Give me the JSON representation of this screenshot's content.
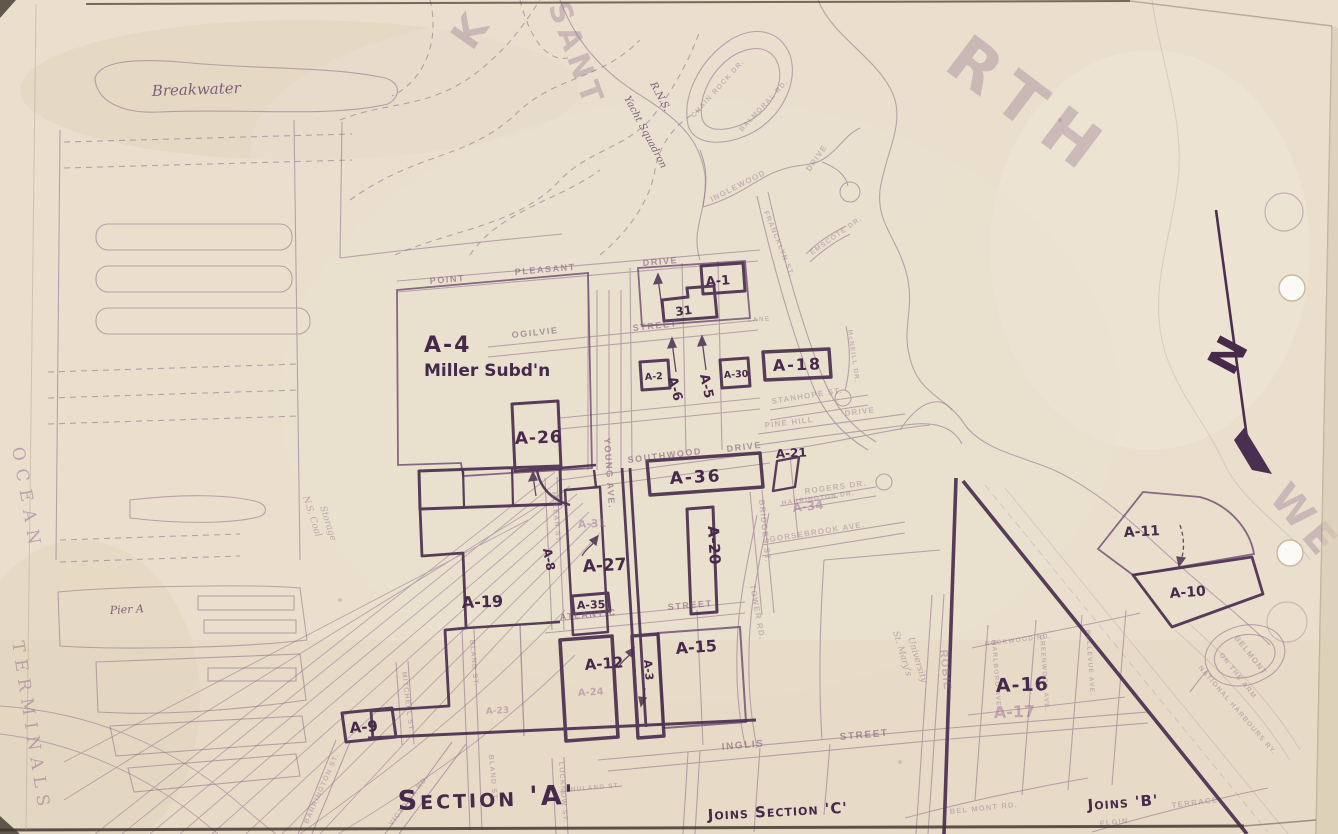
{
  "labels": {
    "compass": "N",
    "water": {
      "north_fragment": "RTH",
      "west_fragment": "WE",
      "park_fragment_k": "K",
      "park_fragment_sant": "SANT"
    },
    "margin": {
      "ocean": "OCEAN",
      "terminals": "TERMINALS"
    },
    "sections": {
      "section_a": "Section 'A'",
      "joins_c": "Joins Section 'C'",
      "joins_b": "Joins 'B'"
    },
    "places": {
      "breakwater": "Breakwater",
      "yacht_line1": "R.N.S.",
      "yacht_line2": "Yacht Squadron",
      "pier_a": "Pier A",
      "storage_line1": "N.S. Coal",
      "storage_line2": "Storage",
      "st_marys_line1": "St. Mary's",
      "st_marys_line2": "University",
      "belmont_loop": "BELMONT",
      "on_the_arm": "ON THE ARM",
      "miller": "Miller Subd'n"
    }
  },
  "streets": {
    "pp_point": "POINT",
    "pp_pleasant": "PLEASANT",
    "w_drive": "DRIVE",
    "w_street": "STREET",
    "ogilvie": "OGILVIE",
    "southwood": "SOUTHWOOD",
    "stanhope": "STANHOPE ST.",
    "pine_hill": "PINE HILL",
    "rogers": "ROGERS DR.",
    "gorsebrook": "GORSEBROOK AVE.",
    "harrington": "HARRINGTON DR.",
    "inglewood": "INGLEWOOD",
    "chain_rock": "CHAIN ROCK DR.",
    "balmoral": "BALMORAL RD.",
    "emscote": "EMSCOTE DR.",
    "lane": "LANE",
    "mcneill": "McNEILL DR.",
    "francklyn": "FRANCKLYN ST.",
    "young_ave": "YOUNG AVE.",
    "tower": "TOWER RD.",
    "bridges": "BRIDGES ST.",
    "atlantic": "ATLANTIC",
    "inglis": "INGLIS",
    "mclean": "McLEAN ST.",
    "bland": "BLAND ST.",
    "mitchell": "MITCHELL ST.",
    "victoria": "VICTORIA RD.",
    "barrington": "BARRINGTON ST.",
    "lucknow": "LUCKNOW ST.",
    "rhuland": "RHULAND ST.",
    "robie": "ROBIE",
    "marlboro": "MARLBORO AVE.",
    "greenwood": "GREENWOOD AVE.",
    "bellevue": "BELLEVUE AVE.",
    "rockwood": "ROCKWOOD RD.",
    "belmont_rd": "BEL MONT RD.",
    "elgin": "ELGIN",
    "terrace": "TERRACE",
    "national_ry": "NATIONAL HARBOURS RY."
  },
  "lots": {
    "a1": "A-1",
    "lot31": "31",
    "a2": "A-2",
    "a3": "A-3",
    "a4": "A-4",
    "a5": "A-5",
    "a6": "A-6",
    "a8": "A-8",
    "a9": "A-9",
    "a10": "A-10",
    "a11": "A-11",
    "a12": "A-12",
    "a15": "A-15",
    "a16": "A-16",
    "a17": "A-17",
    "a18": "A-18",
    "a19": "A-19",
    "a20": "A-20",
    "a21": "A-21",
    "a23": "A-23",
    "a24": "A-24",
    "a26": "A-26",
    "a27": "A-27",
    "a30": "A-30",
    "a31": "A-31",
    "a34": "A-34",
    "a35": "A-35",
    "a36": "A-36"
  }
}
